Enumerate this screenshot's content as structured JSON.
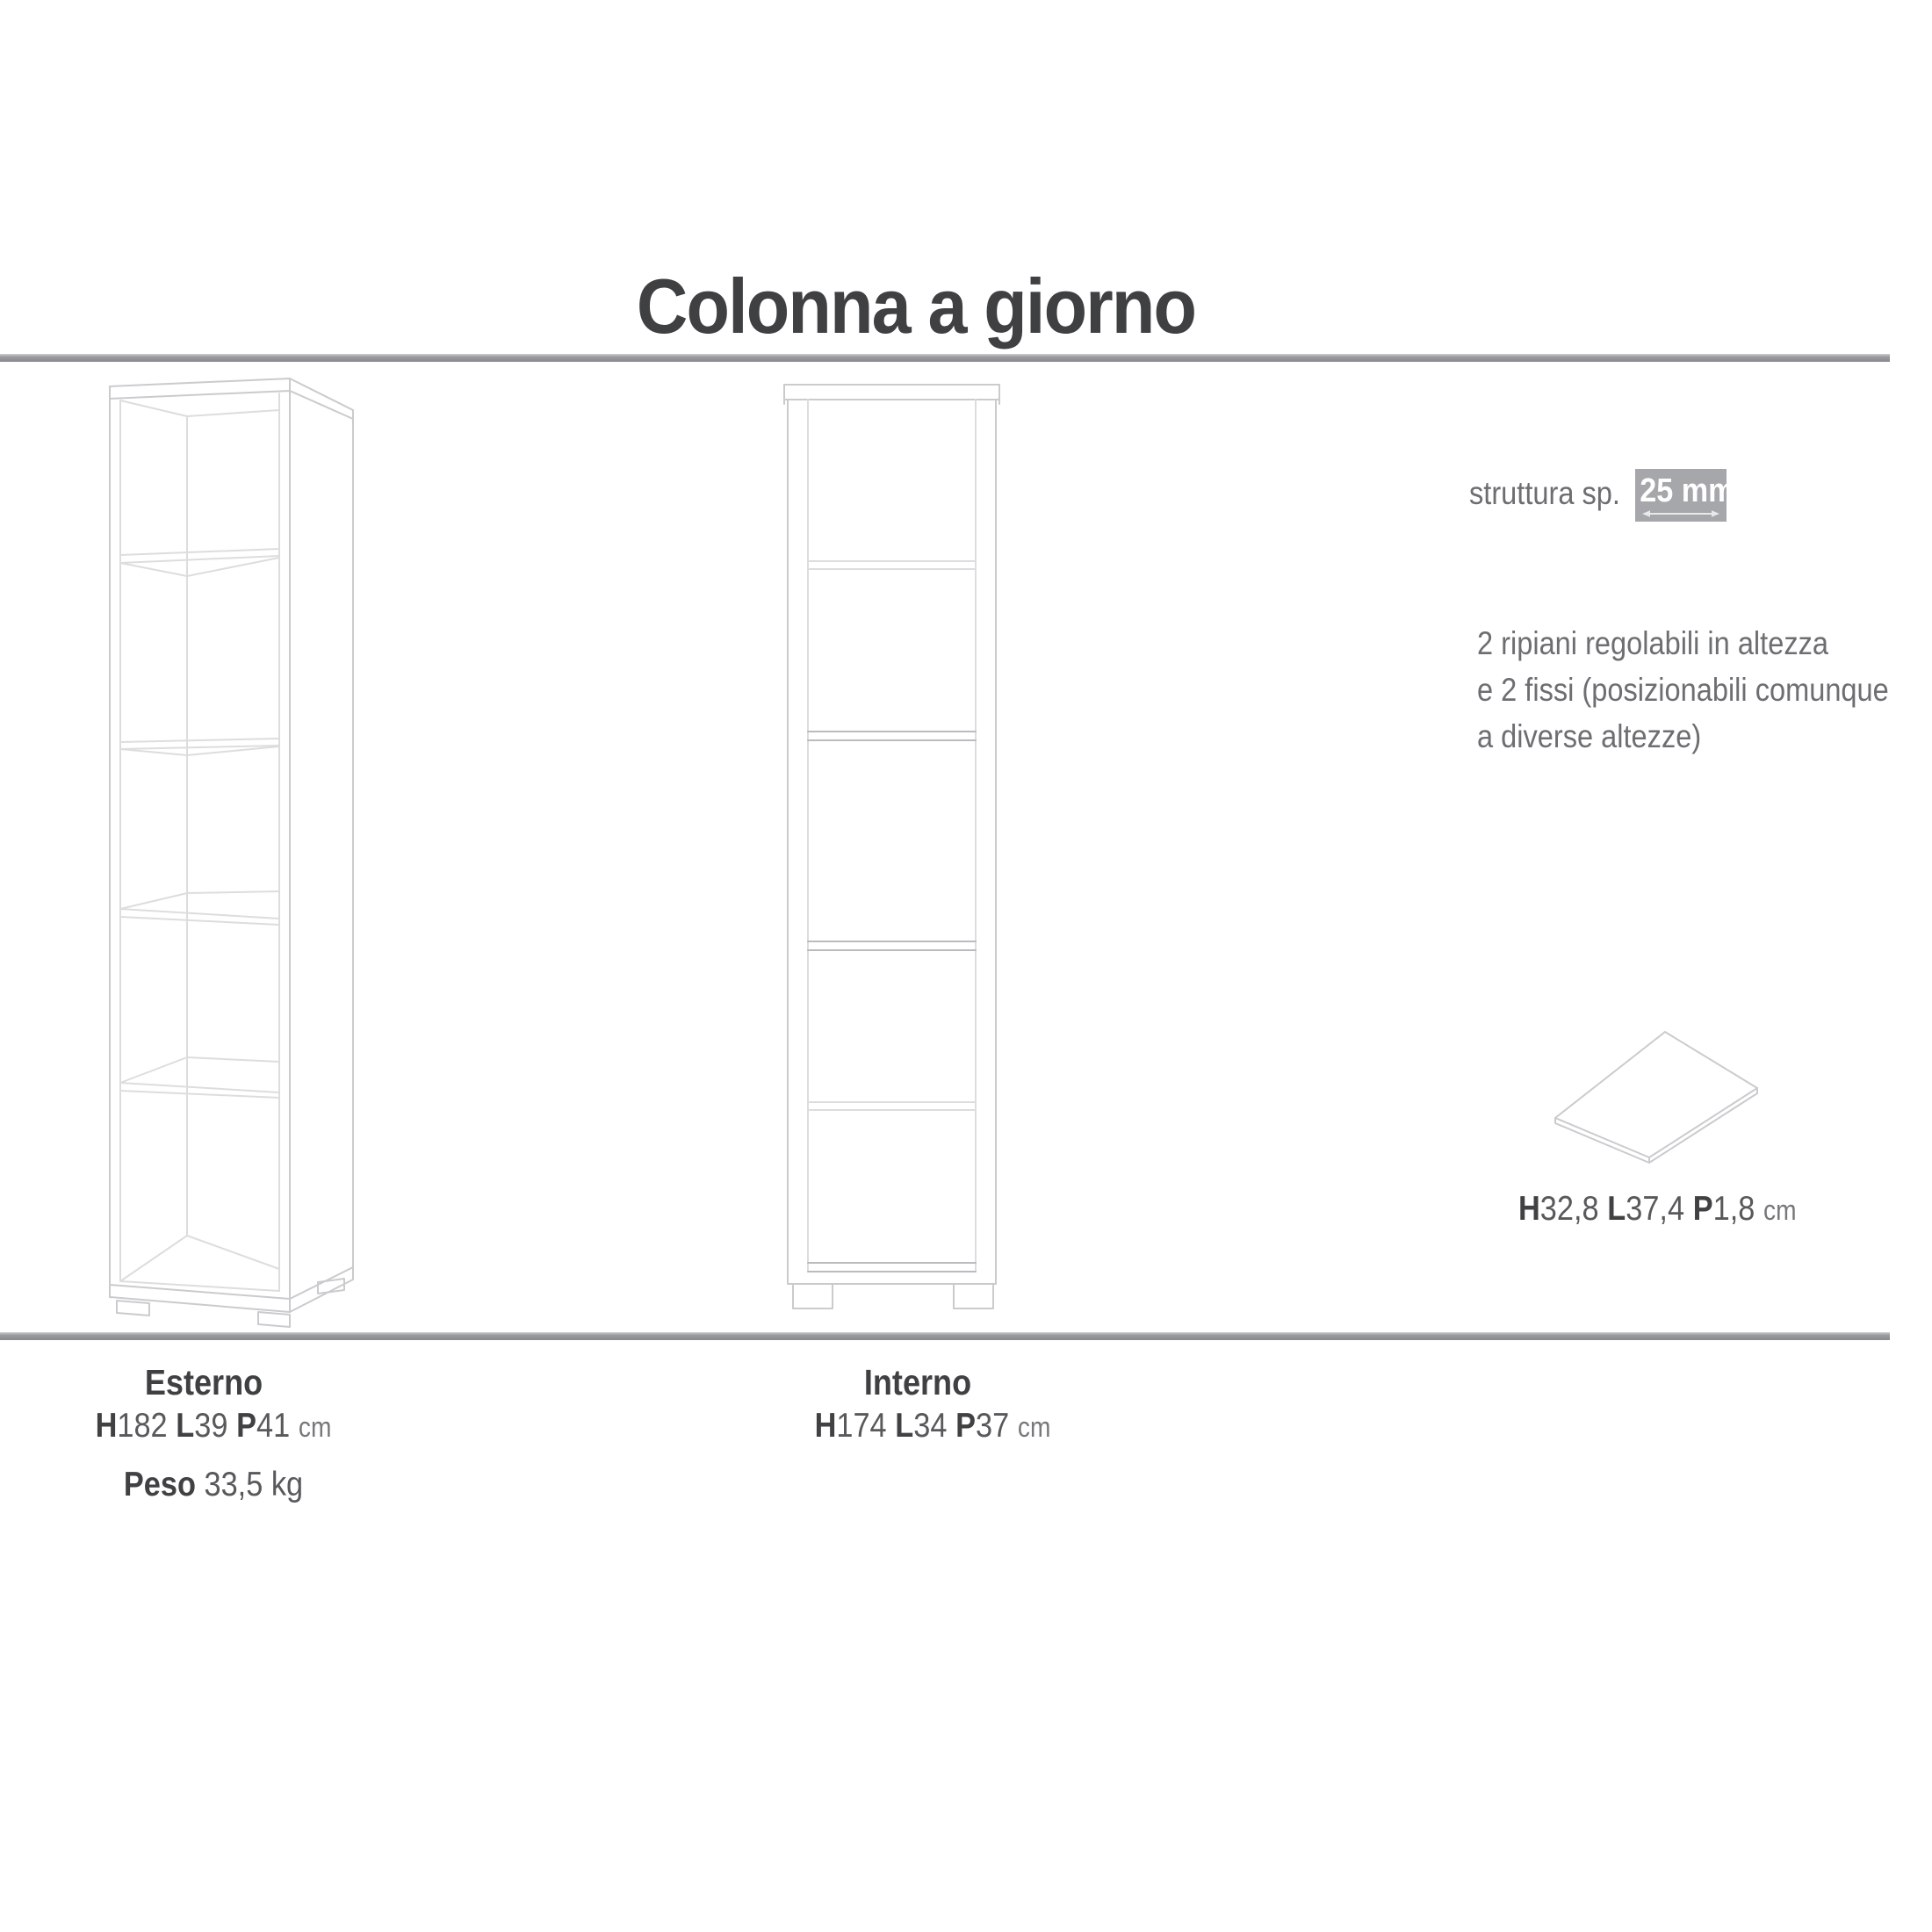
{
  "title": "Colonna a giorno",
  "structure_note": {
    "label": "struttura sp.",
    "thickness": "25 mm"
  },
  "shelves_note": {
    "line1": "2 ripiani regolabili in altezza",
    "line2": "e 2 fissi (posizionabili comunque",
    "line3": "a diverse altezze)"
  },
  "shelf_panel": {
    "h_label": "H",
    "h_value": "32,8",
    "l_label": "L",
    "l_value": "37,4",
    "p_label": "P",
    "p_value": "1,8",
    "unit": "cm"
  },
  "exterior": {
    "label": "Esterno",
    "h_label": "H",
    "h_value": "182",
    "l_label": "L",
    "l_value": "39",
    "p_label": "P",
    "p_value": "41",
    "unit": "cm",
    "weight_label": "Peso",
    "weight_value": "33,5 kg"
  },
  "interior": {
    "label": "Interno",
    "h_label": "H",
    "h_value": "174",
    "l_label": "L",
    "l_value": "34",
    "p_label": "P",
    "p_value": "37",
    "unit": "cm"
  },
  "colors": {
    "text_dark": "#3f4042",
    "text_gray": "#6d6e71",
    "line_light": "#c9cbcd",
    "badge_bg": "#a5a7aa",
    "rule_gray": "#87898c"
  }
}
